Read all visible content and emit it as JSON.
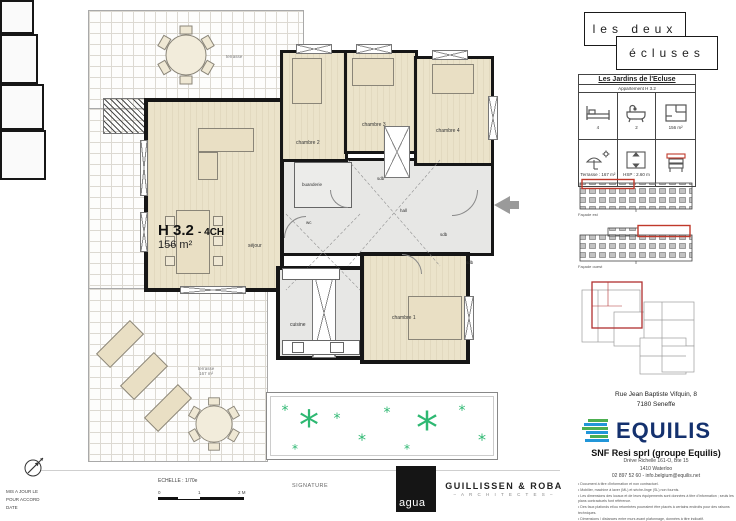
{
  "plan": {
    "unit_code": "H 3.2",
    "unit_type": "- 4CH",
    "unit_area": "156 m²",
    "rooms": {
      "sejour": "séjour",
      "cuisine": "cuisine",
      "chambre1": "chambre 1",
      "chambre2": "chambre 2",
      "chambre3": "chambre 3",
      "chambre4": "chambre 4",
      "buanderie": "buanderie",
      "hall": "hall",
      "wc": "wc",
      "sdb": "sdb",
      "terrasse": "terrasse",
      "terrasse_area": "167 m²"
    }
  },
  "brand": {
    "line1": "les deux",
    "line2": "écluses"
  },
  "info_card": {
    "title": "Les Jardins de l'Ecluse",
    "subtitle": "Appartement H 3.2",
    "bedrooms": "4",
    "bathrooms": "2",
    "area": "156 m²",
    "terrace": "Terrasse : 167 m²",
    "height": "HSP : 2.60 m"
  },
  "elevations": {
    "label_east": "Façade est",
    "label_west": "Façade ouest"
  },
  "address": {
    "line1": "Rue Jean Baptiste Vifquin, 8",
    "line2": "7180 Seneffe"
  },
  "developer": {
    "name": "EQUILIS",
    "company": "SNF Resi sprl (groupe Equilis)",
    "street": "Drève Richelle 161-O, Bte 15",
    "city": "1410 Waterloo",
    "contact": "02 897 52 60  -  info.belgium@equilis.net",
    "disclaimer": [
      "•  Document à titre d'information et non contractuel.",
      "•  Mobilier, machine à laver (ML) et sèche-linge (SL) non fournis.",
      "•  Les dimensions des locaux et de leurs équipements sont données à titre d'information ; seuls les plans contractuels font référence.",
      "•  Des faux plafonds et/ou retombées pourraient être placés à certains endroits pour des raisons techniques.",
      "•  Dimensions / distances entre murs avant plafonnage, données à titre indicatif."
    ]
  },
  "footer": {
    "scale": "ECHELLE : 1/70e",
    "tick0": "0",
    "tick1": "1",
    "tick2": "2 M",
    "signature": "SIGNATURE",
    "agua": "agua",
    "architect": "GUILLISSEN & ROBA",
    "architect_sub": "–  A R C H I T E C T E S  –",
    "left1": "MIS A JOUR LE",
    "left2": "POUR ACCORD",
    "left3": "DATE"
  }
}
